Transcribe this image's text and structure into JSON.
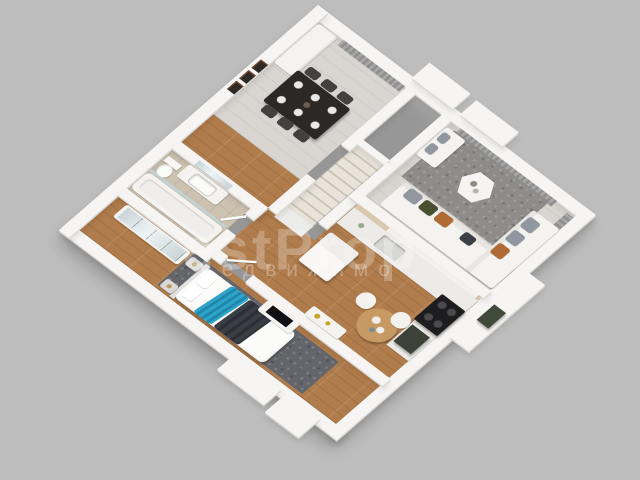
{
  "image": {
    "type": "3d-isometric-floor-plan-render",
    "background": "#bdbdbd"
  },
  "watermark": {
    "line1": "estProp",
    "line2": "недвижимо"
  },
  "palette": {
    "bg": "#bdbdbd",
    "wall": "#f6f5f3",
    "wall-edge": "#d9d8d5",
    "floor-wood": "#b07c4c",
    "floor-light": "#d9d5d0",
    "floor-tile": "#cdc2b0",
    "rug-living": "#8d8c8a",
    "rug-bedroom": "#63656b",
    "sofa": "#f4f3f0",
    "pillow-gray": "#9097a0",
    "pillow-green": "#49502f",
    "pillow-rust": "#b06a35",
    "pillow-dark": "#3c4046",
    "table-dark": "#2c2826",
    "chair-dark": "#43403d",
    "curtain-a": "#a7a7a7",
    "curtain-b": "#8f8f8f",
    "counter": "#ecebe8",
    "backsplash": "#d9c8ad",
    "appliance-black": "#1d1d1f",
    "appliance-green": "#3c4238",
    "wood-light": "#c79a64",
    "mirror-a": "#c9d4d8",
    "mirror-b": "#eef4f6",
    "bed-white": "#fbfbfa",
    "throw-teal": "#2ea3c9",
    "throw-dark": "#3a3f46",
    "stair-a": "#e9e3d9",
    "stair-b": "#c9c2b6",
    "glass": "#bdd8e2"
  },
  "scene": {
    "rooms": [
      {
        "name": "dining-room",
        "items": [
          "dark-dining-table",
          "six-dark-chairs",
          "white-place-settings",
          "three-wall-frames",
          "gray-curtains",
          "entry-closet"
        ]
      },
      {
        "name": "living-room",
        "items": [
          "l-shaped-white-sofa",
          "loveseat",
          "gray-green-rust-pillows",
          "gray-area-rug",
          "hexagonal-coffee-table",
          "gray-curtains-two-windows"
        ]
      },
      {
        "name": "kitchen",
        "items": [
          "white-counters",
          "beige-backsplash",
          "sink",
          "black-stove",
          "fridge",
          "dark-appliance-tower",
          "round-breakfast-table",
          "two-white-chairs",
          "console-with-gold-decor"
        ]
      },
      {
        "name": "staircase",
        "items": [
          "white-stringer-walls",
          "light-wood-treads"
        ]
      },
      {
        "name": "bathroom",
        "items": [
          "vanity-with-sink",
          "wall-mirror",
          "toilet",
          "bathtub",
          "glass-screen",
          "beige-tile"
        ]
      },
      {
        "name": "bedroom",
        "items": [
          "double-bed-white-duvet",
          "teal-throw",
          "dark-throw",
          "two-white-pillows",
          "gray-rug",
          "mirrored-wardrobe",
          "two-nightstands",
          "tv-unit-black-tv"
        ]
      },
      {
        "name": "hallway",
        "items": [
          "wood-floor",
          "door-leaves"
        ]
      }
    ]
  }
}
